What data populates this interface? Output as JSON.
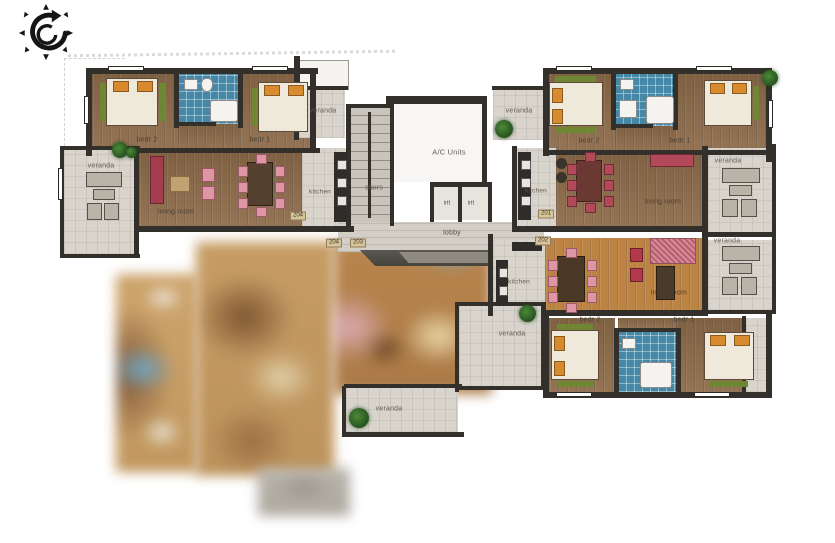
{
  "scene": {
    "type": "apartment-building-floor-plan",
    "background": "#ffffff"
  },
  "icons": {
    "compass": "compass-rotation-icon",
    "plant": "potted-plant-icon"
  },
  "units": {
    "u204": {
      "bedroom2": "bedr 2",
      "bedroom1": "bedr 1",
      "living": "living room",
      "kitchen": "kitchen",
      "veranda": "veranda"
    },
    "u201": {
      "bedroom2": "bedr 2",
      "bedroom1": "bedr 1",
      "living": "living room",
      "kitchen": "kitchen",
      "veranda": "veranda"
    },
    "u202": {
      "bedroom2": "bedr 2",
      "bedroom1": "bedr 1",
      "living": "living room",
      "kitchen": "kitchen",
      "veranda": "veranda"
    }
  },
  "common": {
    "ac_units": "A/C Units",
    "stairs": "stairs",
    "lobby": "lobby",
    "lift_left": "lift",
    "lift_right": "lift",
    "veranda_top_left": "veranda",
    "veranda_top_right": "veranda",
    "veranda_mid": "veranda",
    "veranda_bottom": "veranda"
  },
  "plates": {
    "left_door": "204",
    "lobby_left": "204",
    "lobby_right": "203",
    "right_upper": "201",
    "right_lower": "202"
  },
  "colors": {
    "wall": "#33302b",
    "wood": "#8e6c4a",
    "wood_orange": "#bc8342",
    "tile": "#d8d4cc",
    "bath_tile": "#4587a7",
    "sofa_red": "#b2495a",
    "chair_pink": "#de96a4",
    "bed_orange": "#d78a2e",
    "bed_green": "#6f8733",
    "plant_green": "#2e5e26",
    "blur_tan": "#c99f66",
    "blur_blue": "#79aec8",
    "blur_pink": "#d8a9b3",
    "blur_gray": "#b5b0a7"
  }
}
